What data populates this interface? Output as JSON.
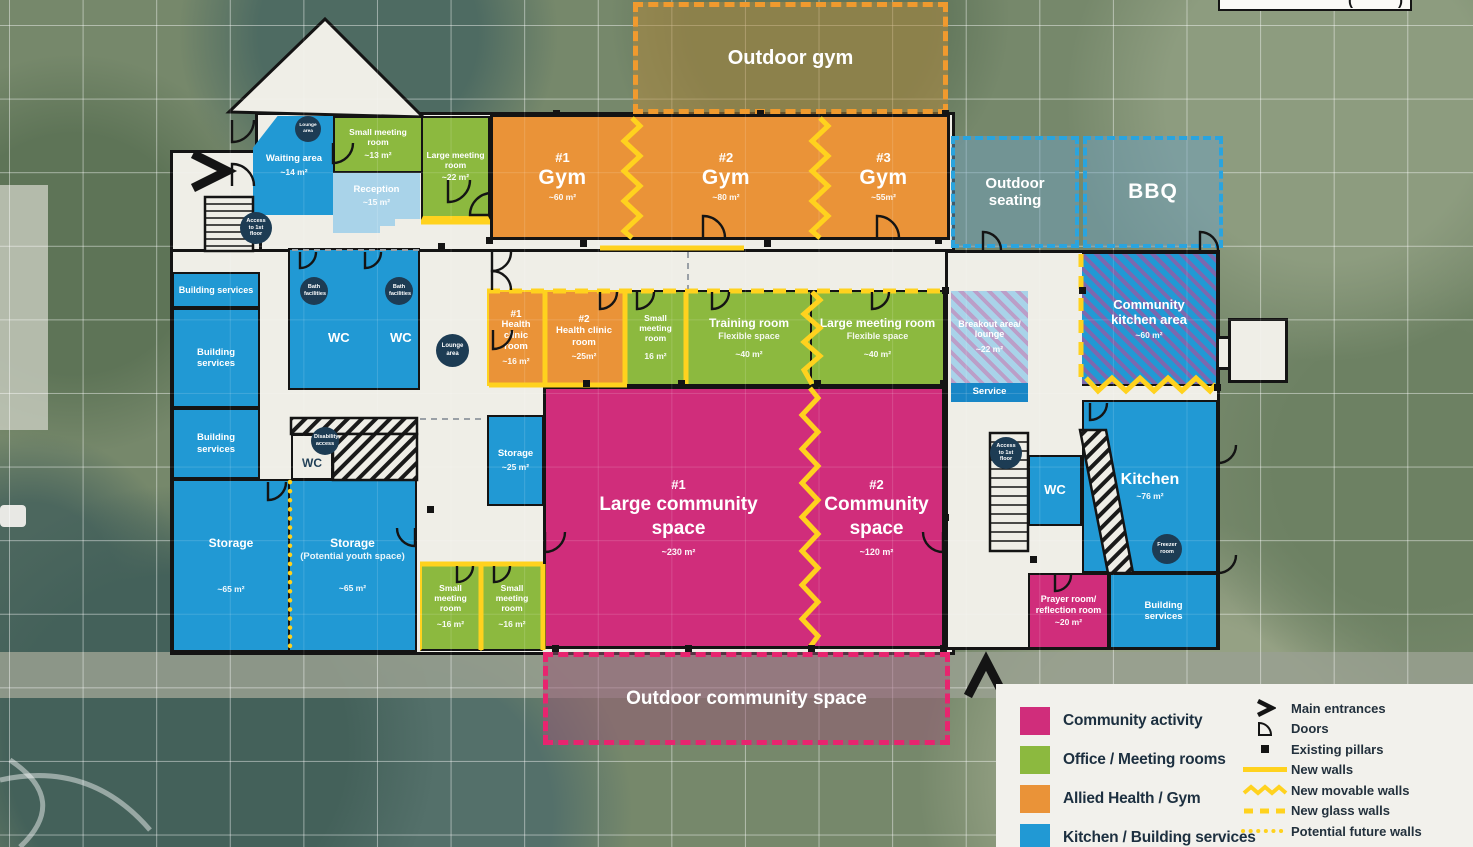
{
  "colors": {
    "community": "#d02d7b",
    "office": "#8cb93f",
    "health": "#ea9338",
    "kitchen": "#2199d4",
    "wall_yellow": "#ffd21e",
    "navy_badge": "#1d3c54"
  },
  "outdoor": {
    "gym": "Outdoor gym",
    "seating": "Outdoor seating",
    "bbq": "BBQ",
    "community_space": "Outdoor community space"
  },
  "scale_box": {
    "left": "(",
    "right": ")"
  },
  "rooms": {
    "waiting": {
      "name": "Waiting area",
      "area": "~14 m²"
    },
    "small_meeting_top": {
      "name": "Small meeting room",
      "area": "~13 m²"
    },
    "reception": {
      "name": "Reception",
      "area": "~15 m²"
    },
    "large_meeting_top": {
      "name": "Large meeting room",
      "area": "~22 m²"
    },
    "gym1": {
      "num": "#1",
      "name": "Gym",
      "area": "~60 m²"
    },
    "gym2": {
      "num": "#2",
      "name": "Gym",
      "area": "~80 m²"
    },
    "gym3": {
      "num": "#3",
      "name": "Gym",
      "area": "~55m²"
    },
    "building_services_1": {
      "name": "Building services"
    },
    "building_services_2": {
      "name": "Building services"
    },
    "building_services_3": {
      "name": "Building services"
    },
    "wc_left_1": {
      "name": "WC"
    },
    "wc_left_2": {
      "name": "WC"
    },
    "wc_disability": {
      "name": "WC"
    },
    "storage_left": {
      "name": "Storage",
      "area": "~65 m²"
    },
    "storage_youth": {
      "name": "Storage",
      "note": "(Potential youth space)",
      "area": "~65 m²"
    },
    "storage_25": {
      "name": "Storage",
      "area": "~25 m²"
    },
    "clinic1": {
      "num": "#1",
      "name": "Health clinic room",
      "area": "~16 m²"
    },
    "clinic2": {
      "num": "#2",
      "name": "Health clinic room",
      "area": "~25m²"
    },
    "small_meeting_mid": {
      "name": "Small meeting room",
      "area": "16 m²"
    },
    "training": {
      "name": "Training room",
      "note": "Flexible space",
      "area": "~40 m²"
    },
    "large_meeting_mid": {
      "name": "Large meeting room",
      "note": "Flexible space",
      "area": "~40 m²"
    },
    "breakout": {
      "name": "Breakout area/ lounge",
      "area": "~22 m²"
    },
    "service": {
      "name": "Service"
    },
    "community_kitchen": {
      "name": "Community kitchen area",
      "area": "~60 m²"
    },
    "community1": {
      "num": "#1",
      "name": "Large community space",
      "area": "~230 m²"
    },
    "community2": {
      "num": "#2",
      "name": "Community space",
      "area": "~120 m²"
    },
    "small_meeting_b1": {
      "name": "Small meeting room",
      "area": "~16 m²"
    },
    "small_meeting_b2": {
      "name": "Small meeting room",
      "area": "~16 m²"
    },
    "kitchen": {
      "name": "Kitchen",
      "area": "~76 m²"
    },
    "wc_right": {
      "name": "WC"
    },
    "prayer": {
      "name": "Prayer room/ reflection room",
      "area": "~20 m²"
    },
    "building_services_right": {
      "name": "Building services"
    }
  },
  "badges": {
    "lounge_small": "Lounge area",
    "access_first_floor_left": "Access to 1st floor",
    "bath_facilities_1": "Bath facilities",
    "bath_facilities_2": "Bath facilities",
    "lounge_mid": "Lounge area",
    "disability_access": "Disability access",
    "access_first_floor_right": "Access to 1st floor",
    "freezer": "Freezer room"
  },
  "legend": {
    "categories": [
      {
        "label": "Community activity",
        "color": "#d02d7b"
      },
      {
        "label": "Office / Meeting rooms",
        "color": "#8cb93f"
      },
      {
        "label": "Allied Health / Gym",
        "color": "#ea9338"
      },
      {
        "label": "Kitchen / Building services",
        "color": "#2199d4"
      }
    ],
    "symbols": [
      {
        "label": "Main entrances",
        "type": "chevron"
      },
      {
        "label": "Doors",
        "type": "door-arc"
      },
      {
        "label": "Existing pillars",
        "type": "square"
      },
      {
        "label": "New walls",
        "type": "solid-yellow"
      },
      {
        "label": "New movable walls",
        "type": "zigzag-yellow"
      },
      {
        "label": "New glass walls",
        "type": "dashed-yellow"
      },
      {
        "label": "Potential future walls",
        "type": "dotted-yellow"
      }
    ]
  }
}
